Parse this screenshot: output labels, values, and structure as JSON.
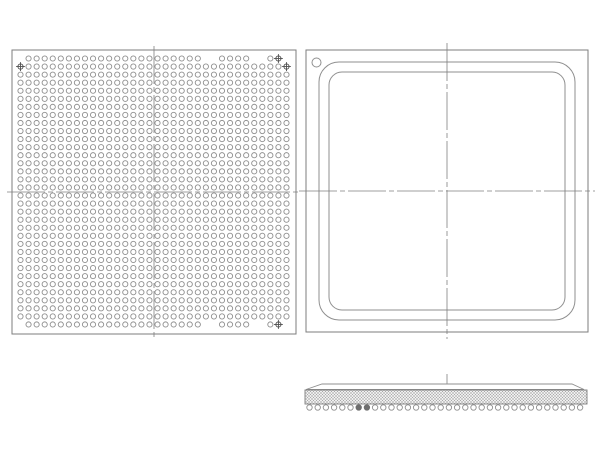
{
  "title": "BGA package outline drawing (bottom view, top view, side view)",
  "colors": {
    "background": "#ffffff",
    "outline": "#7d7d7d",
    "ball_stroke": "#8f8f8f",
    "ball_fill": "#ffffff",
    "centerline": "#808080",
    "target": "#4f4f4f",
    "hatch": "#a8a8a8",
    "hatch_bg": "#efefef",
    "filled_ball": "#6e6e6e"
  },
  "bottom_view": {
    "label": "bottom-view-ball-grid",
    "rect": {
      "x": 12,
      "y": 50,
      "w": 284,
      "h": 284
    },
    "grid": {
      "rows": 34,
      "cols": 34,
      "pitch": 8.06,
      "start_x": 20.5,
      "start_y": 58.5,
      "ball_r": 2.6
    },
    "special_rows": {
      "1": {
        "empty": [
          1,
          24,
          25,
          30,
          31,
          34
        ],
        "target": [
          33
        ]
      },
      "2": {
        "empty": [],
        "target": [
          1,
          34
        ]
      },
      "34": {
        "empty": [
          1,
          24,
          25,
          30,
          31,
          34
        ],
        "target": [
          33
        ]
      }
    },
    "centerline": {
      "vx": 154,
      "vy1": 46,
      "vy2": 338,
      "hy": 192,
      "hx1": 7,
      "hx2": 301
    }
  },
  "top_view": {
    "label": "top-view",
    "rect": {
      "x": 306,
      "y": 50,
      "w": 282,
      "h": 282
    },
    "body_outline": {
      "x": 319,
      "y": 62,
      "w": 256,
      "h": 258,
      "r": 20
    },
    "lid_outline": {
      "x": 329,
      "y": 72,
      "w": 236,
      "h": 238,
      "r": 13
    },
    "pin1": {
      "cx": 316.5,
      "cy": 62.5,
      "r": 4.5
    },
    "centerline": {
      "vx": 447,
      "vy1": 43,
      "vy2": 339,
      "hy": 191,
      "hx1": 299,
      "hx2": 595
    }
  },
  "side_view": {
    "label": "side-profile-view",
    "lid": {
      "bot_x1": 306,
      "bot_x2": 584,
      "top_x1": 322,
      "top_x2": 572,
      "top_y": 384,
      "bot_y": 389.5
    },
    "band": {
      "x": 305,
      "y": 390,
      "w": 282,
      "h": 14
    },
    "balls": {
      "count": 34,
      "start_x": 309.5,
      "pitch": 8.2,
      "cy": 407.5,
      "r": 2.7,
      "filled": [
        7,
        8
      ]
    },
    "centerline": {
      "vx": 447,
      "vy1": 374,
      "vy2": 404
    }
  }
}
